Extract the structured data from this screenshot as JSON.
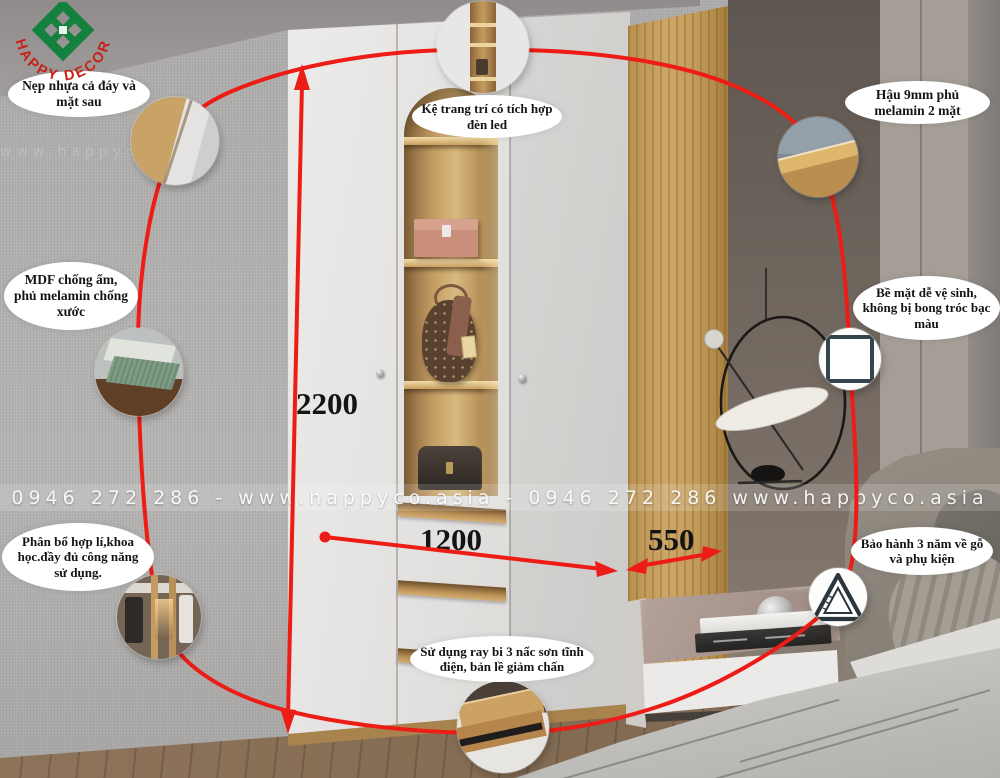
{
  "logo": {
    "text": "HAPPY DECOR"
  },
  "watermark": {
    "text": "0946 272 286 - www.happyco.asia - 0946 272 286 www.happyco.asia",
    "ghost": "www.happyco.asia"
  },
  "dimensions": {
    "height": "2200",
    "width": "1200",
    "depth": "550"
  },
  "callouts": [
    {
      "name": "edge-trim",
      "text": "Nẹp nhựa cả đáy và mặt sau"
    },
    {
      "name": "mdf-material",
      "text": "MDF chống ẩm, phủ melamin chống xước"
    },
    {
      "name": "layout",
      "text": "Phân bổ hợp lí,khoa học.đầy đủ công năng sử dụng."
    },
    {
      "name": "led-shelf",
      "text": "Kệ trang trí có tích hợp đèn led"
    },
    {
      "name": "back-panel",
      "text": "Hậu 9mm phủ melamin 2 mặt"
    },
    {
      "name": "surface",
      "text": "Bề mặt dễ vệ sinh, không bị bong tróc bạc màu"
    },
    {
      "name": "warranty",
      "text": "Bảo hành 3 năm về gỗ và phụ kiện"
    },
    {
      "name": "drawer-rail",
      "text": "Sử dụng ray bi 3 nấc sơn tĩnh điện, bản lề giảm chấn"
    }
  ],
  "insets": [
    "wood-corner-photo",
    "mdf-board-photo",
    "interior-layout-photo",
    "shelf-detail-photo",
    "back-panel-corner-photo",
    "white-surface-sample",
    "triangle-ruler-icon",
    "drawer-rail-photo"
  ],
  "colors": {
    "annotation_red": "#ed1c16",
    "logo_green": "#15813e",
    "logo_red": "#c9221a",
    "wood_oak": "#c9a162",
    "door_white": "#e6e5e3"
  }
}
